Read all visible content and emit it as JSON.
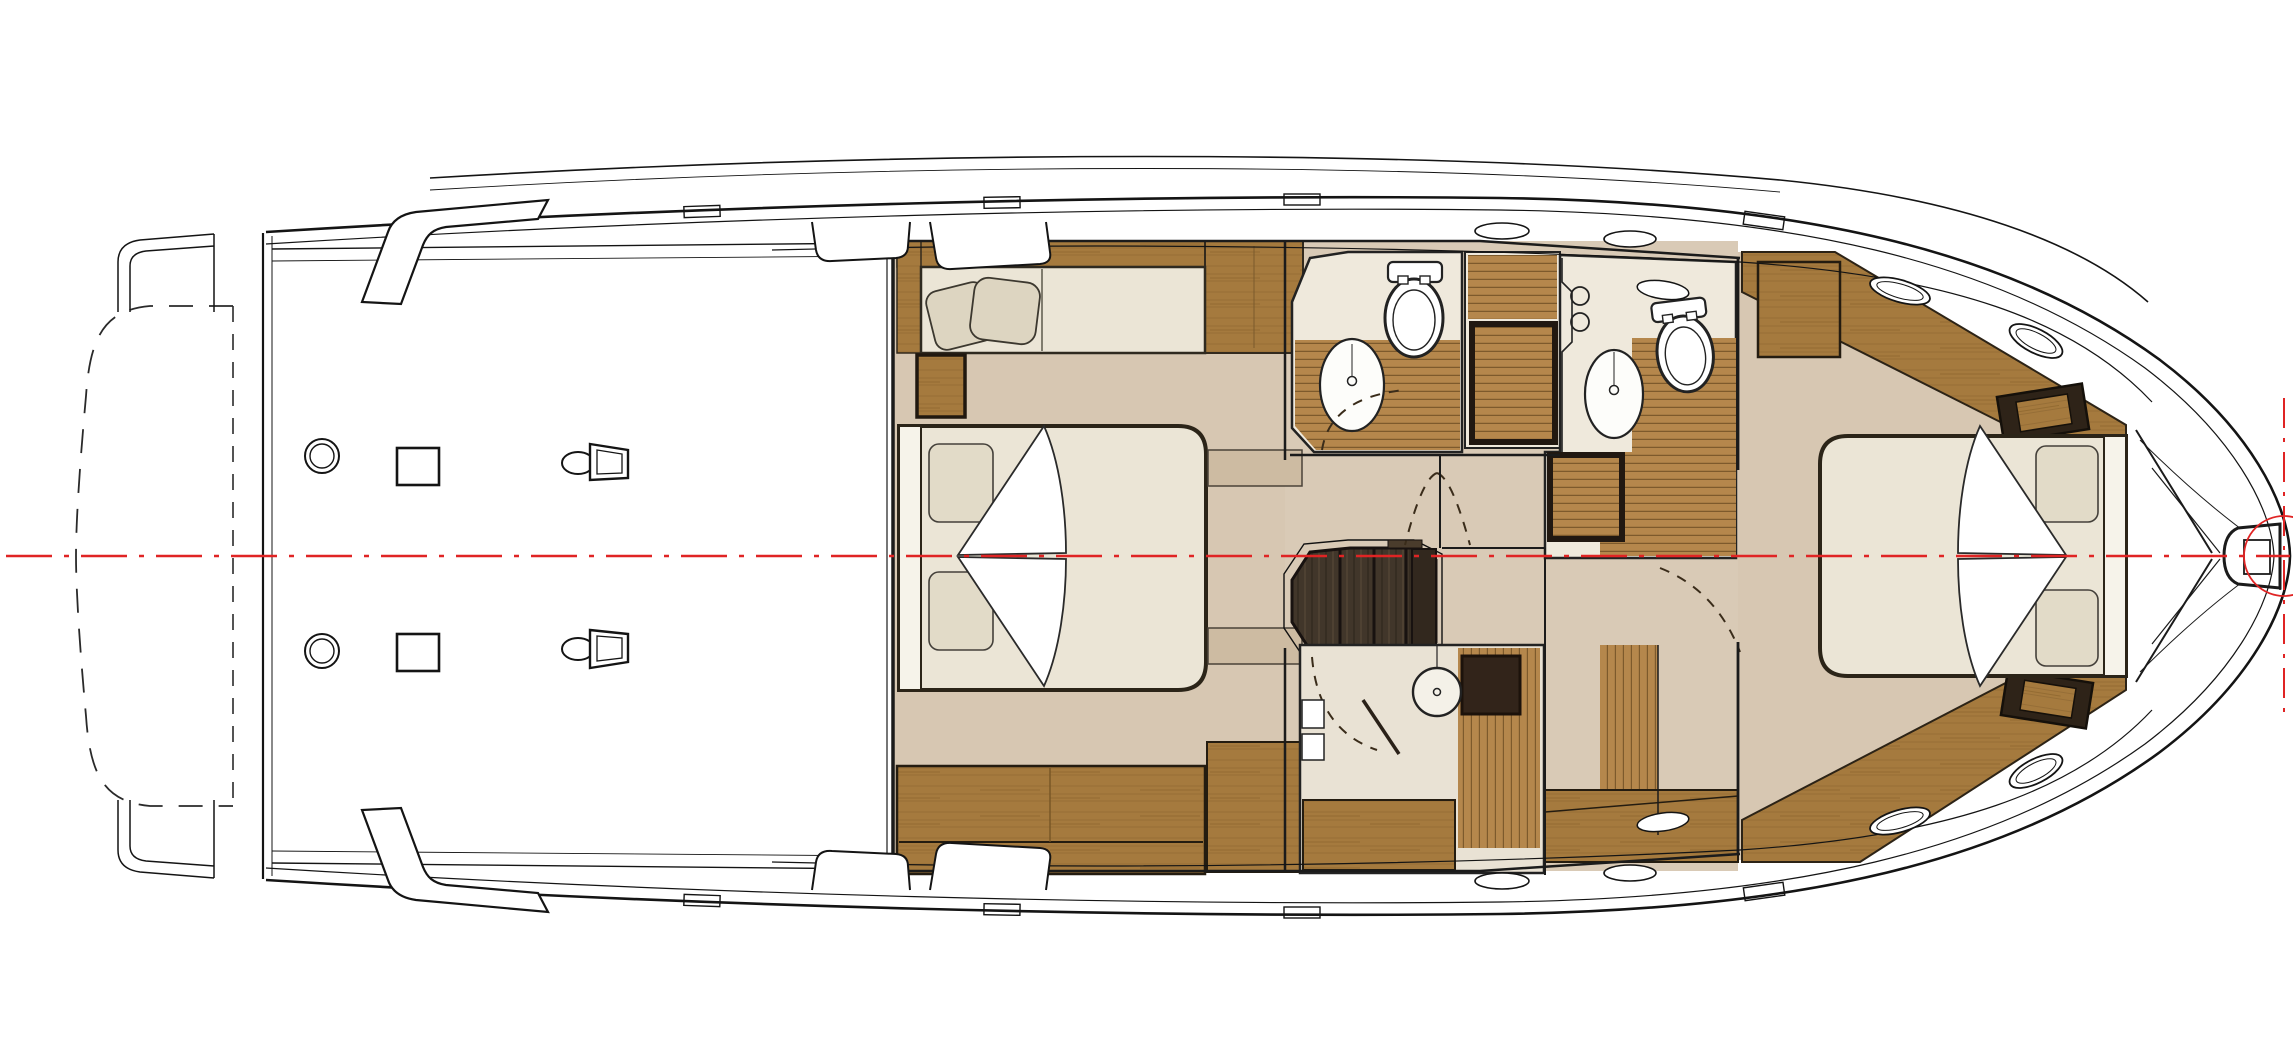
{
  "meta": {
    "title": "Motor yacht lower-deck accommodation floor plan, bow to the right",
    "drawing_type": "boat-deck-plan",
    "visible_text": "none"
  },
  "palette": {
    "paper": "#ffffff",
    "line": "#1b1b1b",
    "centerline_red": "#e02424",
    "floor_tan": "#d7c7b2",
    "floor_stone": "#efe9dc",
    "mattress_cream": "#ebe5d6",
    "pillow_cream": "#ddd5c1",
    "wood_cabinet": "#a57a3e",
    "wood_teak_floor": "#b5874c",
    "wood_dark_stairs": "#41362a",
    "wood_espresso": "#32241a"
  },
  "diagram": {
    "orientation": "bow-right",
    "symmetry": "red dash-dot centerline through hull",
    "areas": [
      {
        "id": "swim-platform",
        "style": "dashed outline extension aft"
      },
      {
        "id": "aft-deck",
        "fixtures": [
          "deck-ring",
          "deck-ring",
          "deck-hatch-square",
          "deck-hatch-square",
          "mooring-cleat",
          "mooring-cleat"
        ]
      },
      {
        "id": "midship-cabin",
        "fixtures": [
          "settee-berth-with-pillows",
          "wardrobe",
          "double-bed-head-aft",
          "bed-pillows",
          "step-box",
          "storage-cabinets",
          "bedside-steps"
        ]
      },
      {
        "id": "port-head",
        "fixtures": [
          "toilet",
          "oval-sink",
          "teak-floor",
          "door-swing"
        ]
      },
      {
        "id": "midship-shower",
        "fixtures": [
          "teak-shower-tray"
        ]
      },
      {
        "id": "starboard-head",
        "fixtures": [
          "toilet",
          "oval-sink",
          "twin-faucets",
          "teak-floor",
          "teak-shower-tray"
        ]
      },
      {
        "id": "companionway-stairs",
        "steps": 4,
        "material": "dark-wood"
      },
      {
        "id": "day-head",
        "fixtures": [
          "round-sink",
          "espresso-counter",
          "teak-floor",
          "cabinets",
          "door-leaf",
          "door-swing"
        ]
      },
      {
        "id": "forward-cabin",
        "fixtures": [
          "double-bed-head-forward",
          "bed-pillows",
          "nightstand",
          "nightstand",
          "hull-wardrobe",
          "hull-wardrobe",
          "door-swing"
        ]
      },
      {
        "id": "bow",
        "fixtures": [
          "chain-locker-vee",
          "anchor-windlass",
          "red-reference-circle",
          "red-vertical-datum"
        ]
      }
    ],
    "portholes_count": 8,
    "deck_hatches_count": 4
  }
}
